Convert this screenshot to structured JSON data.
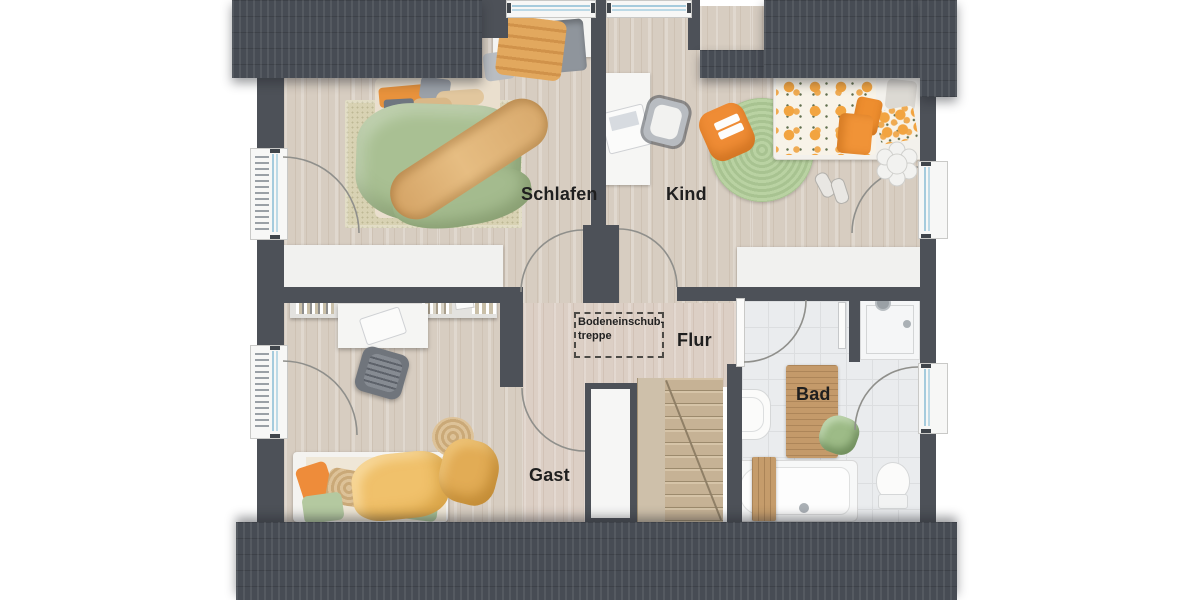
{
  "plan_title": "attic-floor-plan",
  "rooms": {
    "schlafen": {
      "label": "Schlafen"
    },
    "kind": {
      "label": "Kind"
    },
    "flur": {
      "label": "Flur"
    },
    "gast": {
      "label": "Gast"
    },
    "bad": {
      "label": "Bad"
    },
    "loft_hatch": {
      "line1": "Bodeneinschub-",
      "line2": "treppe"
    }
  },
  "colors": {
    "roof": "#474c54",
    "wall": "#4d5158",
    "wood_floor": "#d7cdc1",
    "tile_floor": "#eaecee",
    "accent_orange": "#ee8e2f",
    "accent_green": "#a9c093",
    "window_glass": "#a5cbdd",
    "label_text": "#1f1f1f"
  }
}
